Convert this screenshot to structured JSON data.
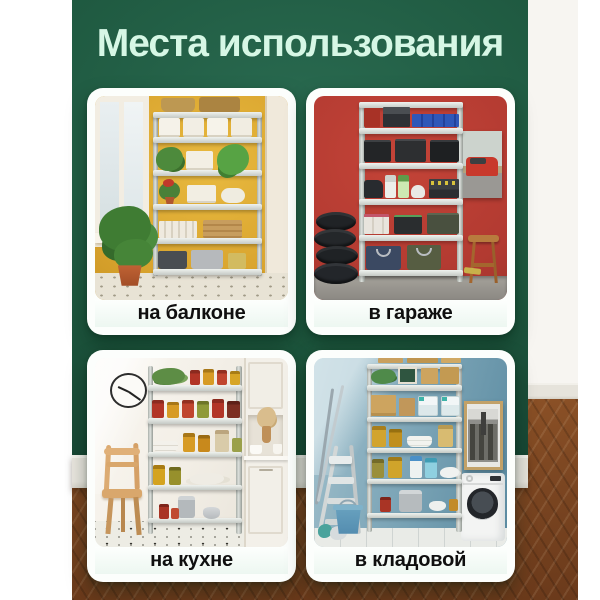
{
  "title": "Места использования",
  "cards": [
    {
      "id": "balcony",
      "label": "на балконе"
    },
    {
      "id": "garage",
      "label": "в гараже"
    },
    {
      "id": "kitchen",
      "label": "на кухне"
    },
    {
      "id": "pantry",
      "label": "в кладовой"
    }
  ],
  "colors": {
    "wall_green_light": "#2a6b51",
    "wall_green_dark": "#153f30",
    "title_text": "#d6f7e5",
    "card_bg": "#fcfefc",
    "caption_text": "#0f0f0f",
    "balcony_wall": "#d9a42e",
    "garage_wall": "#b23a31",
    "kitchen_wall": "#f3efe7",
    "pantry_wall": "#84abbc",
    "baseboard": "#e9e6df",
    "wood_floor": "#7a4521",
    "shelf_metal": "#cdd1cd"
  }
}
